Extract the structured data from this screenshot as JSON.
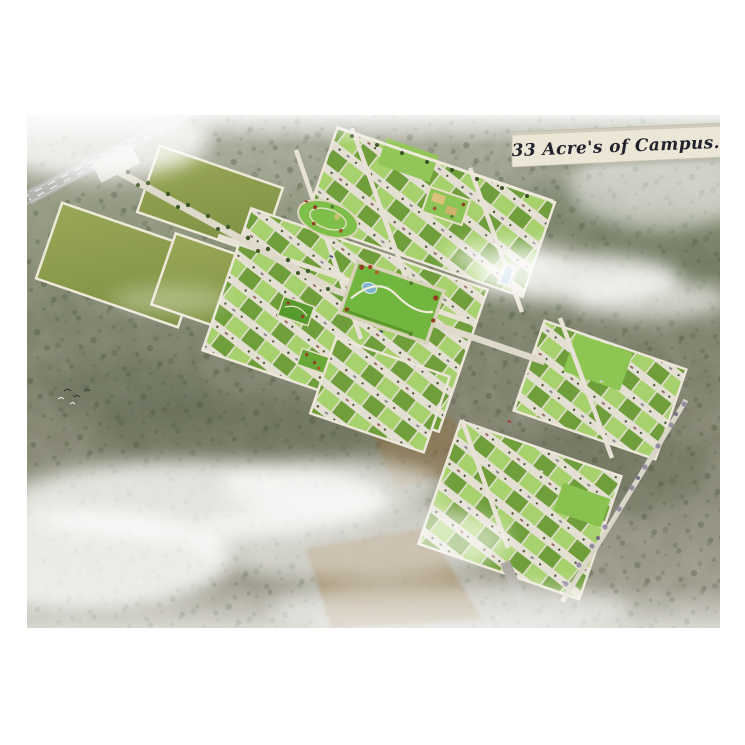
{
  "banner": {
    "text": "33 Acre's of Campus."
  },
  "scene": {
    "description": "Aerial 3D rendering of a 33-acre plotted township campus surrounded by scrubland, fog and farmland",
    "site_features": [
      "highway",
      "entry-road",
      "open-fields",
      "checkered-plot-blocks",
      "oval-park",
      "kids-play-park",
      "central-park",
      "garden-strips",
      "swimming-pool",
      "boundary-roads",
      "exit-road",
      "farm-patches",
      "scrub-forest",
      "fog-clouds",
      "birds"
    ]
  },
  "colors": {
    "page_bg": "#ffffff",
    "plot_light": "#a7d16c",
    "plot_dark": "#6f9e3a",
    "road": "#e4dfd3",
    "highway": "#b2b4b1",
    "open_field": "#93a351",
    "park_lawn": "#71b63e",
    "water": "#7fb3cc",
    "terrain": "#7d8166",
    "banner_bg": "#ebe6d5",
    "banner_text": "#23232e"
  }
}
